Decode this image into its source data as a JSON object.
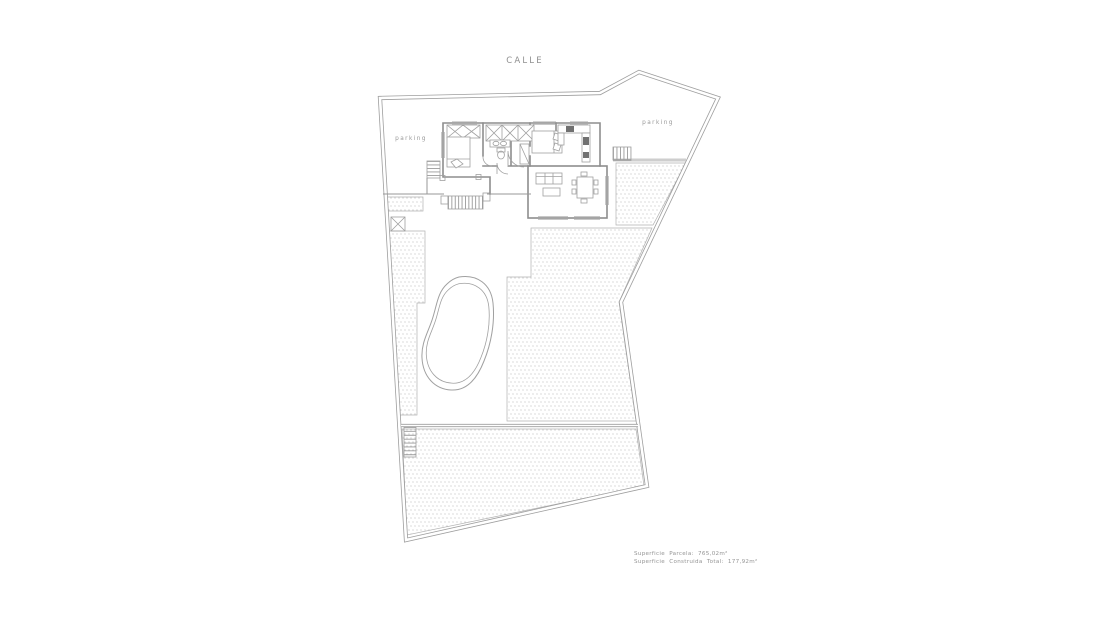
{
  "title": "CALLE",
  "labels": {
    "parking_left": "parking",
    "parking_right": "parking"
  },
  "summary": {
    "parcel": "Superficie Parcela: 765,02m²",
    "built": "Superficie Construida Total: 177,92m²"
  },
  "measurements": {
    "parcel_area_m2": "765,02",
    "built_area_m2": "177,92"
  },
  "colors": {
    "background": "#ffffff",
    "boundary_line": "#9e9e9e",
    "wall_line": "#8e8e8e",
    "thin_line": "#a8a8a8",
    "stipple_dot": "#a9a9a9",
    "text": "#8f8f8f"
  }
}
